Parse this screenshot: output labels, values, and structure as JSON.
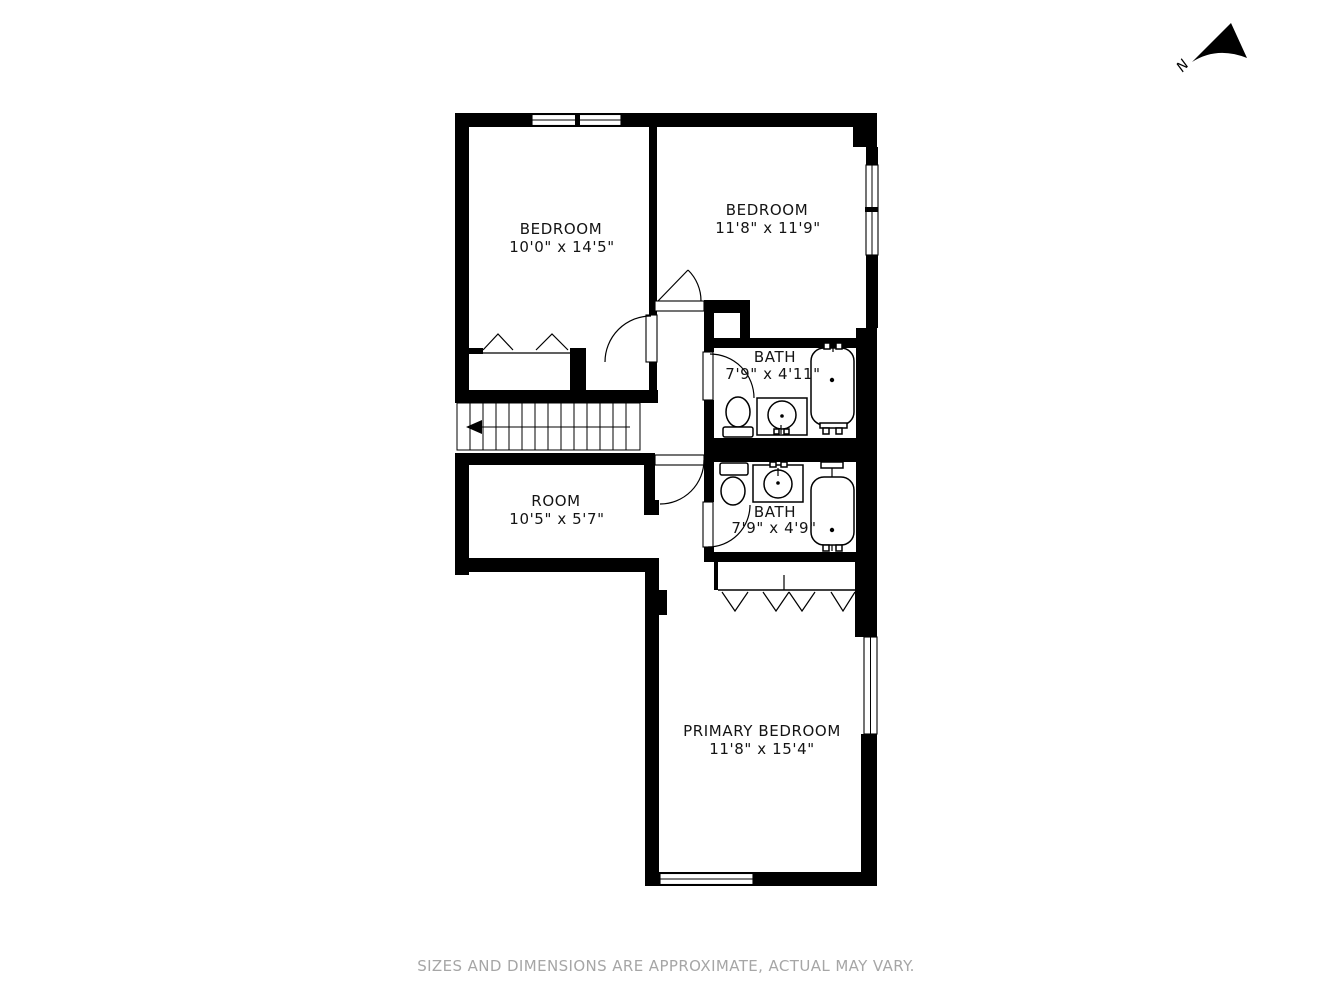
{
  "compass": {
    "label": "N"
  },
  "rooms": [
    {
      "id": "bedroom-1",
      "name": "BEDROOM",
      "dims": "10'0\" x 14'5\""
    },
    {
      "id": "bedroom-2",
      "name": "BEDROOM",
      "dims": "11'8\" x 11'9\""
    },
    {
      "id": "bath-upper",
      "name": "BATH",
      "dims": "7'9\" x 4'11\""
    },
    {
      "id": "hall-room",
      "name": "ROOM",
      "dims": "10'5\" x 5'7\""
    },
    {
      "id": "bath-lower",
      "name": "BATH",
      "dims": "7'9\" x 4'9\""
    },
    {
      "id": "primary-bedroom",
      "name": "PRIMARY BEDROOM",
      "dims": "11'8\" x 15'4\""
    }
  ],
  "footer": {
    "disclaimer": "SIZES AND DIMENSIONS ARE APPROXIMATE, ACTUAL MAY VARY."
  },
  "colors": {
    "wall": "#000000",
    "label_text": "#141414",
    "disclaimer_text": "#a6a6a6",
    "background": "#ffffff"
  }
}
